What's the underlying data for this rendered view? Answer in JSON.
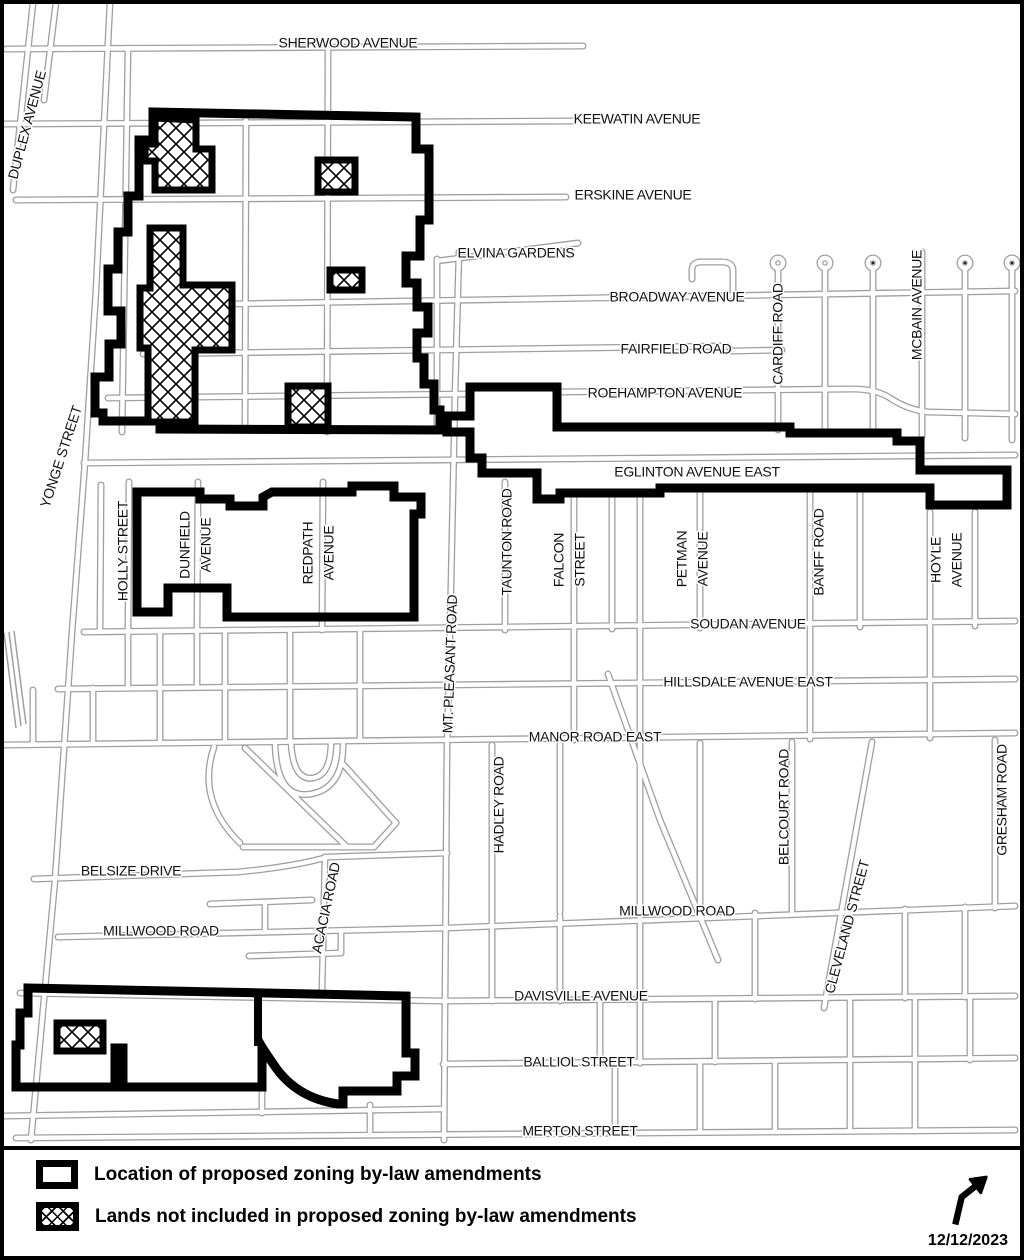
{
  "map": {
    "colors": {
      "street": "#9f9f9f",
      "boundary": "#000000",
      "background": "#ffffff",
      "label": "#111111"
    },
    "street_labels": [
      {
        "text": "SHERWOOD AVENUE",
        "x": 348,
        "y": 44,
        "rot": 0
      },
      {
        "text": "KEEWATIN AVENUE",
        "x": 637,
        "y": 120,
        "rot": 0
      },
      {
        "text": "ERSKINE AVENUE",
        "x": 633,
        "y": 196,
        "rot": 0
      },
      {
        "text": "ELVINA GARDENS",
        "x": 516,
        "y": 254,
        "rot": 0
      },
      {
        "text": "BROADWAY AVENUE",
        "x": 677,
        "y": 298,
        "rot": 0
      },
      {
        "text": "FAIRFIELD ROAD",
        "x": 676,
        "y": 350,
        "rot": 0
      },
      {
        "text": "ROEHAMPTON AVENUE",
        "x": 665,
        "y": 394,
        "rot": 0
      },
      {
        "text": "EGLINTON AVENUE EAST",
        "x": 697,
        "y": 473,
        "rot": 0,
        "size": 15
      },
      {
        "text": "SOUDAN AVENUE",
        "x": 748,
        "y": 625,
        "rot": 0
      },
      {
        "text": "HILLSDALE AVENUE EAST",
        "x": 748,
        "y": 683,
        "rot": 0
      },
      {
        "text": "MANOR ROAD EAST",
        "x": 595,
        "y": 738,
        "rot": 0
      },
      {
        "text": "MILLWOOD ROAD",
        "x": 677,
        "y": 912,
        "rot": 0
      },
      {
        "text": "BELSIZE DRIVE",
        "x": 131,
        "y": 872,
        "rot": 0
      },
      {
        "text": "MILLWOOD ROAD",
        "x": 161,
        "y": 932,
        "rot": 0
      },
      {
        "text": "DAVISVILLE AVENUE",
        "x": 581,
        "y": 997,
        "rot": 0
      },
      {
        "text": "BALLIOL STREET",
        "x": 579,
        "y": 1063,
        "rot": 0
      },
      {
        "text": "MERTON STREET",
        "x": 580,
        "y": 1132,
        "rot": 0
      },
      {
        "text": "DUPLEX AVENUE",
        "x": 28,
        "y": 125,
        "rot": -75
      },
      {
        "text": "YONGE STREET",
        "x": 62,
        "y": 457,
        "rot": -72,
        "size": 15
      },
      {
        "text": "HOLLY STREET",
        "x": 124,
        "y": 551,
        "rot": -90
      },
      {
        "lines": [
          "DUNFIELD",
          "AVENUE"
        ],
        "x": 186,
        "y": 545,
        "rot": -90
      },
      {
        "lines": [
          "REDPATH",
          "AVENUE"
        ],
        "x": 309,
        "y": 553,
        "rot": -90
      },
      {
        "text": "MT. PLEASANT ROAD",
        "x": 451,
        "y": 664,
        "rot": -88
      },
      {
        "text": "TAUNTON ROAD",
        "x": 508,
        "y": 542,
        "rot": -90
      },
      {
        "lines": [
          "FALCON",
          "STREET"
        ],
        "x": 560,
        "y": 560,
        "rot": -90
      },
      {
        "lines": [
          "PETMAN",
          "AVENUE"
        ],
        "x": 683,
        "y": 559,
        "rot": -90
      },
      {
        "text": "BANFF ROAD",
        "x": 820,
        "y": 552,
        "rot": -90
      },
      {
        "lines": [
          "HOYLE",
          "AVENUE"
        ],
        "x": 937,
        "y": 560,
        "rot": -90
      },
      {
        "text": "CARDIFF ROAD",
        "x": 779,
        "y": 334,
        "rot": -90
      },
      {
        "text": "MCBAIN AVENUE",
        "x": 918,
        "y": 305,
        "rot": -90
      },
      {
        "text": "HADLEY ROAD",
        "x": 500,
        "y": 805,
        "rot": -90
      },
      {
        "text": "BELCOURT ROAD",
        "x": 785,
        "y": 807,
        "rot": -90
      },
      {
        "text": "GRESHAM ROAD",
        "x": 1003,
        "y": 800,
        "rot": -90
      },
      {
        "text": "CLEVELAND STREET",
        "x": 848,
        "y": 927,
        "rot": -75
      },
      {
        "text": "ACACIA ROAD",
        "x": 327,
        "y": 908,
        "rot": -78
      }
    ]
  },
  "legend": {
    "items": [
      {
        "symbol": "zoning-outline-swatch",
        "label": "Location of proposed zoning by-law amendments"
      },
      {
        "symbol": "hatched-swatch",
        "label": "Lands not included in proposed zoning by-law amendments"
      }
    ],
    "north_arrow_icon": "north-arrow",
    "date": "12/12/2023"
  }
}
